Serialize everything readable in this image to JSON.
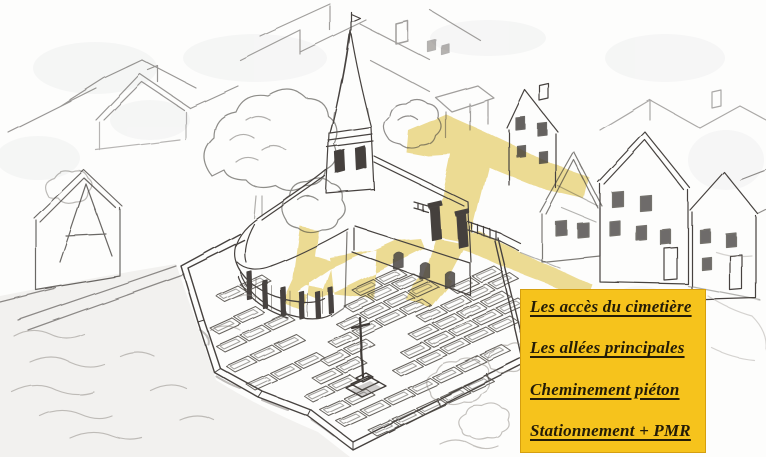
{
  "illustration": {
    "name": "aerial-sketch-church-cemetery",
    "description": "Croquis aérien dessiné à la main : église au chevet arrondi avec clocher, cimetière clos de murs avec tombes et croix centrale, maisons du village, accès et allées surlignés en jaune",
    "highlight_color": "#e9d37d",
    "ink_color": "#47433f",
    "paper_color": "#fdfdfc"
  },
  "legend": {
    "background_color": "#f6c31c",
    "text_color": "#241c07",
    "items": [
      {
        "label": "Les accès du cimetière"
      },
      {
        "label": "Les allées principales"
      },
      {
        "label": "Cheminement piéton"
      },
      {
        "label": "Stationnement + PMR"
      }
    ]
  }
}
